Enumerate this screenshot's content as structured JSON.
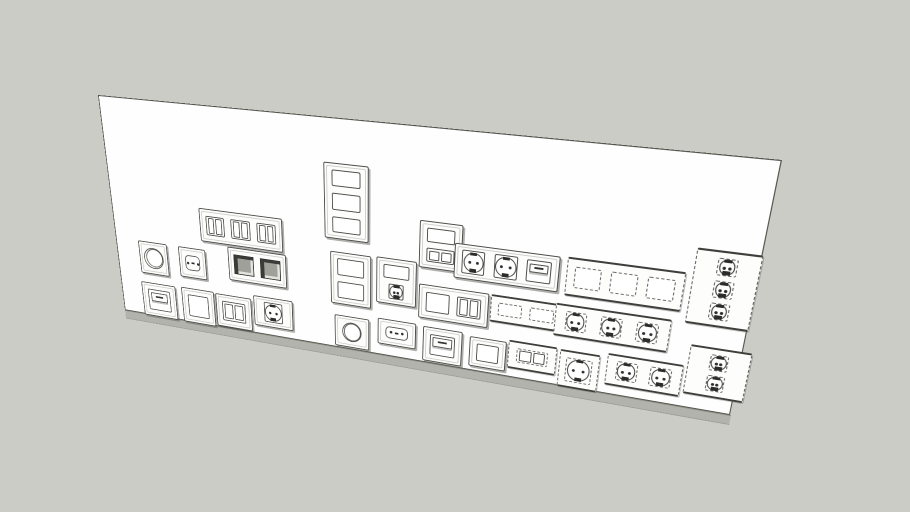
{
  "scene": {
    "description": "3D hidden-line render of a white wall panel fitted with European electrical wall plates (sockets, switches, dimmers), some drawn with dashed outlines",
    "colors": {
      "background": "#cbccc6",
      "panel_face": "#fefefe",
      "panel_outline": "#55554f",
      "panel_side_edge": "#b2b3ac",
      "line": "#4c4c48",
      "dashed_line": "#6a6a66",
      "dark_recess": "#3b3b38",
      "socket_marks": "#2c2c2a"
    }
  },
  "module_types": {
    "blank": "blank cover plate opening",
    "rocker2": "double rocker switch",
    "dimmer": "rotary dimmer knob",
    "euro": "two-pin euro socket",
    "schuko": "grounded schuko socket",
    "keystone": "recessed keystone jack opening",
    "flap": "socket with hinged flap cover"
  },
  "fixtures": [
    {
      "id": "switch-row-triple",
      "style": "solid",
      "orient": "h",
      "x": 113,
      "y": 110,
      "w": 102,
      "h": 38,
      "modules": [
        "rocker2",
        "rocker2",
        "rocker2"
      ]
    },
    {
      "id": "dimmer-a",
      "style": "solid",
      "orient": "h",
      "x": 29,
      "y": 158,
      "w": 38,
      "h": 39,
      "modules": [
        "dimmer"
      ]
    },
    {
      "id": "euro-socket-a",
      "style": "solid",
      "orient": "h",
      "x": 82,
      "y": 158,
      "w": 35,
      "h": 36,
      "modules": [
        "euro"
      ]
    },
    {
      "id": "keystone-double",
      "style": "solid",
      "orient": "h",
      "x": 146,
      "y": 150,
      "w": 72,
      "h": 39,
      "modules": [
        "keystone",
        "keystone"
      ]
    },
    {
      "id": "flap-socket-a",
      "style": "solid",
      "orient": "h",
      "x": 27,
      "y": 208,
      "w": 46,
      "h": 42,
      "modules": [
        "flap"
      ]
    },
    {
      "id": "blank-plate-a",
      "style": "solid",
      "orient": "h",
      "x": 81,
      "y": 207,
      "w": 43,
      "h": 43,
      "modules": [
        "blank"
      ]
    },
    {
      "id": "rocker-switch-a",
      "style": "solid",
      "orient": "h",
      "x": 126,
      "y": 208,
      "w": 46,
      "h": 40,
      "modules": [
        "rocker2"
      ]
    },
    {
      "id": "schuko-socket-a",
      "style": "solid",
      "orient": "h",
      "x": 175,
      "y": 203,
      "w": 49,
      "h": 36,
      "modules": [
        "schuko"
      ]
    },
    {
      "id": "frame-triple-v-blank",
      "style": "solid",
      "orient": "v",
      "x": 265,
      "y": 44,
      "w": 50,
      "h": 80,
      "modules": [
        "blank",
        "blank",
        "blank"
      ]
    },
    {
      "id": "frame-double-v-blank",
      "style": "solid",
      "orient": "v",
      "x": 271,
      "y": 138,
      "w": 47,
      "h": 59,
      "modules": [
        "blank",
        "blank"
      ]
    },
    {
      "id": "frame-double-v-schuko",
      "style": "solid",
      "orient": "v",
      "x": 324,
      "y": 137,
      "w": 45,
      "h": 51,
      "modules": [
        "blank",
        "schuko"
      ]
    },
    {
      "id": "dimmer-b",
      "style": "solid",
      "orient": "h",
      "x": 275,
      "y": 210,
      "w": 41,
      "h": 37,
      "modules": [
        "dimmer"
      ]
    },
    {
      "id": "euro-socket-b",
      "style": "solid",
      "orient": "h",
      "x": 326,
      "y": 206,
      "w": 44,
      "h": 30,
      "modules": [
        "euro"
      ]
    },
    {
      "id": "frame-double-v-rocker",
      "style": "solid",
      "orient": "v",
      "x": 371,
      "y": 92,
      "w": 46,
      "h": 50,
      "modules": [
        "blank",
        "rocker2"
      ]
    },
    {
      "id": "frame-triple-h-schuko-flap",
      "style": "solid",
      "orient": "h",
      "x": 409,
      "y": 111,
      "w": 108,
      "h": 37,
      "modules": [
        "schuko",
        "schuko",
        "flap"
      ]
    },
    {
      "id": "frame-double-h-rocker",
      "style": "solid",
      "orient": "h",
      "x": 372,
      "y": 160,
      "w": 76,
      "h": 38,
      "modules": [
        "blank",
        "rocker2"
      ]
    },
    {
      "id": "frame-double-h-dashed",
      "style": "dashed",
      "orient": "h",
      "x": 450,
      "y": 160,
      "w": 74,
      "h": 30,
      "modules": [
        "blank",
        "blank"
      ]
    },
    {
      "id": "flap-socket-b",
      "style": "solid",
      "orient": "h",
      "x": 378,
      "y": 207,
      "w": 44,
      "h": 40,
      "modules": [
        "flap"
      ]
    },
    {
      "id": "blank-plate-b",
      "style": "solid",
      "orient": "h",
      "x": 430,
      "y": 210,
      "w": 40,
      "h": 34,
      "modules": [
        "blank"
      ]
    },
    {
      "id": "rocker-switch-dashed",
      "style": "dashed",
      "orient": "h",
      "x": 472,
      "y": 207,
      "w": 51,
      "h": 32,
      "modules": [
        "rocker2"
      ]
    },
    {
      "id": "frame-triple-h-blank-dashed",
      "style": "dashed",
      "orient": "h",
      "x": 524,
      "y": 110,
      "w": 112,
      "h": 40,
      "modules": [
        "blank",
        "blank",
        "blank"
      ]
    },
    {
      "id": "frame-triple-h-schuko-dashed",
      "style": "dashed",
      "orient": "h",
      "x": 517,
      "y": 159,
      "w": 113,
      "h": 35,
      "modules": [
        "schuko",
        "schuko",
        "schuko"
      ]
    },
    {
      "id": "schuko-socket-dashed",
      "style": "dashed",
      "orient": "h",
      "x": 526,
      "y": 208,
      "w": 41,
      "h": 42,
      "modules": [
        "schuko"
      ]
    },
    {
      "id": "frame-double-h-schuko-dashed",
      "style": "dashed",
      "orient": "h",
      "x": 574,
      "y": 204,
      "w": 74,
      "h": 35,
      "modules": [
        "schuko",
        "schuko"
      ]
    },
    {
      "id": "frame-triple-v-schuko-dashed",
      "style": "dashed",
      "orient": "v",
      "x": 642,
      "y": 85,
      "w": 58,
      "h": 75,
      "modules": [
        "schuko",
        "schuko",
        "schuko"
      ]
    },
    {
      "id": "frame-double-v-schuko-dashed",
      "style": "dashed",
      "orient": "v",
      "x": 651,
      "y": 181,
      "w": 57,
      "h": 53,
      "modules": [
        "schuko",
        "schuko"
      ]
    }
  ]
}
